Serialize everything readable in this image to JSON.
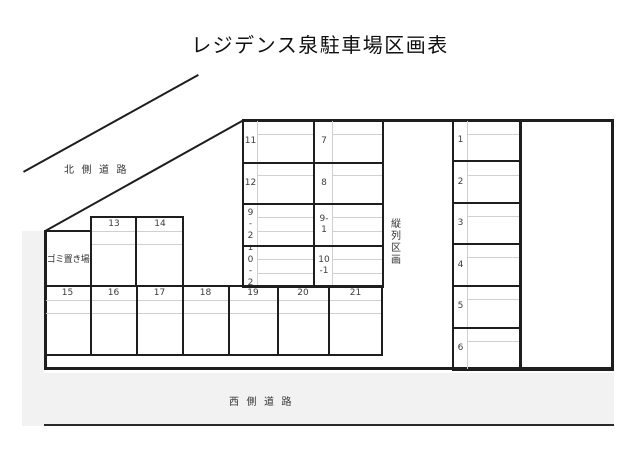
{
  "title": "レジデンス泉駐車場区画表",
  "roads": {
    "north": "北側道路",
    "west": "西側道路"
  },
  "areas": {
    "garbage": "ゴミ置き場",
    "tandem": "縦\n列\n区\n画"
  },
  "stalls": {
    "middle_left": [
      "11",
      "12",
      "9\n-\n2",
      "1\n0\n-\n2"
    ],
    "middle_right": [
      "7",
      "8",
      "9-\n1",
      "10\n-1"
    ],
    "right_col": [
      "1",
      "2",
      "3",
      "4",
      "5",
      "6"
    ],
    "upper": [
      "13",
      "14"
    ],
    "bottom": [
      "15",
      "16",
      "17",
      "18",
      "19",
      "20",
      "21"
    ]
  },
  "colors": {
    "line": "#1e1e1e",
    "faint_grid": "#d0d0d0",
    "road_fill": "#f2f2f2",
    "text": "#3d3d3d"
  }
}
